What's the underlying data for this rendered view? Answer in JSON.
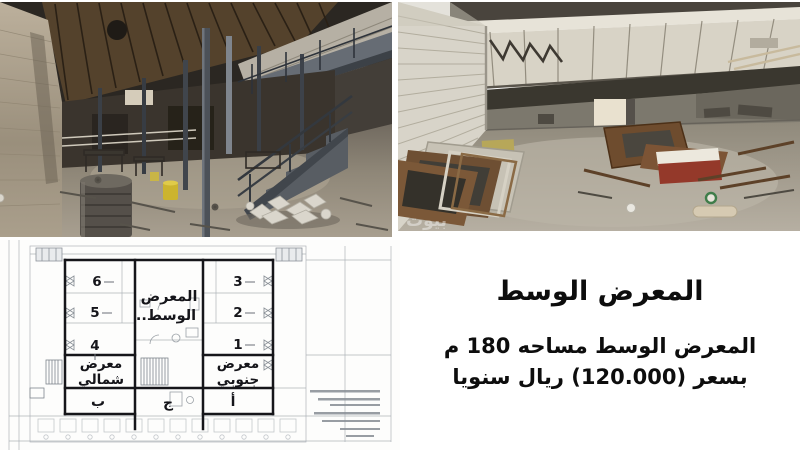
{
  "listing": {
    "title": "المعرض الوسط",
    "details_line1": "المعرض الوسط مساحه 180 م",
    "details_line2": "بسعر (120.000) ريال سنويا"
  },
  "floor_plan": {
    "center_room_line1": "المعرض",
    "center_room_line2": "الوسط..",
    "north_showroom_line1": "معرض",
    "north_showroom_line2": "شمالي",
    "south_showroom_line1": "معرض",
    "south_showroom_line2": "جنوبي",
    "rooms": [
      "6",
      "5",
      "4",
      "3",
      "2",
      "1"
    ],
    "section_b": "ب",
    "section_j": "ج",
    "section_a": "أ"
  },
  "photos": {
    "watermark": "بيوت"
  },
  "colors": {
    "plan_heavy_line": "#16161a",
    "plan_faint_line": "#a9aeb4",
    "text": "#0d0d0d"
  }
}
